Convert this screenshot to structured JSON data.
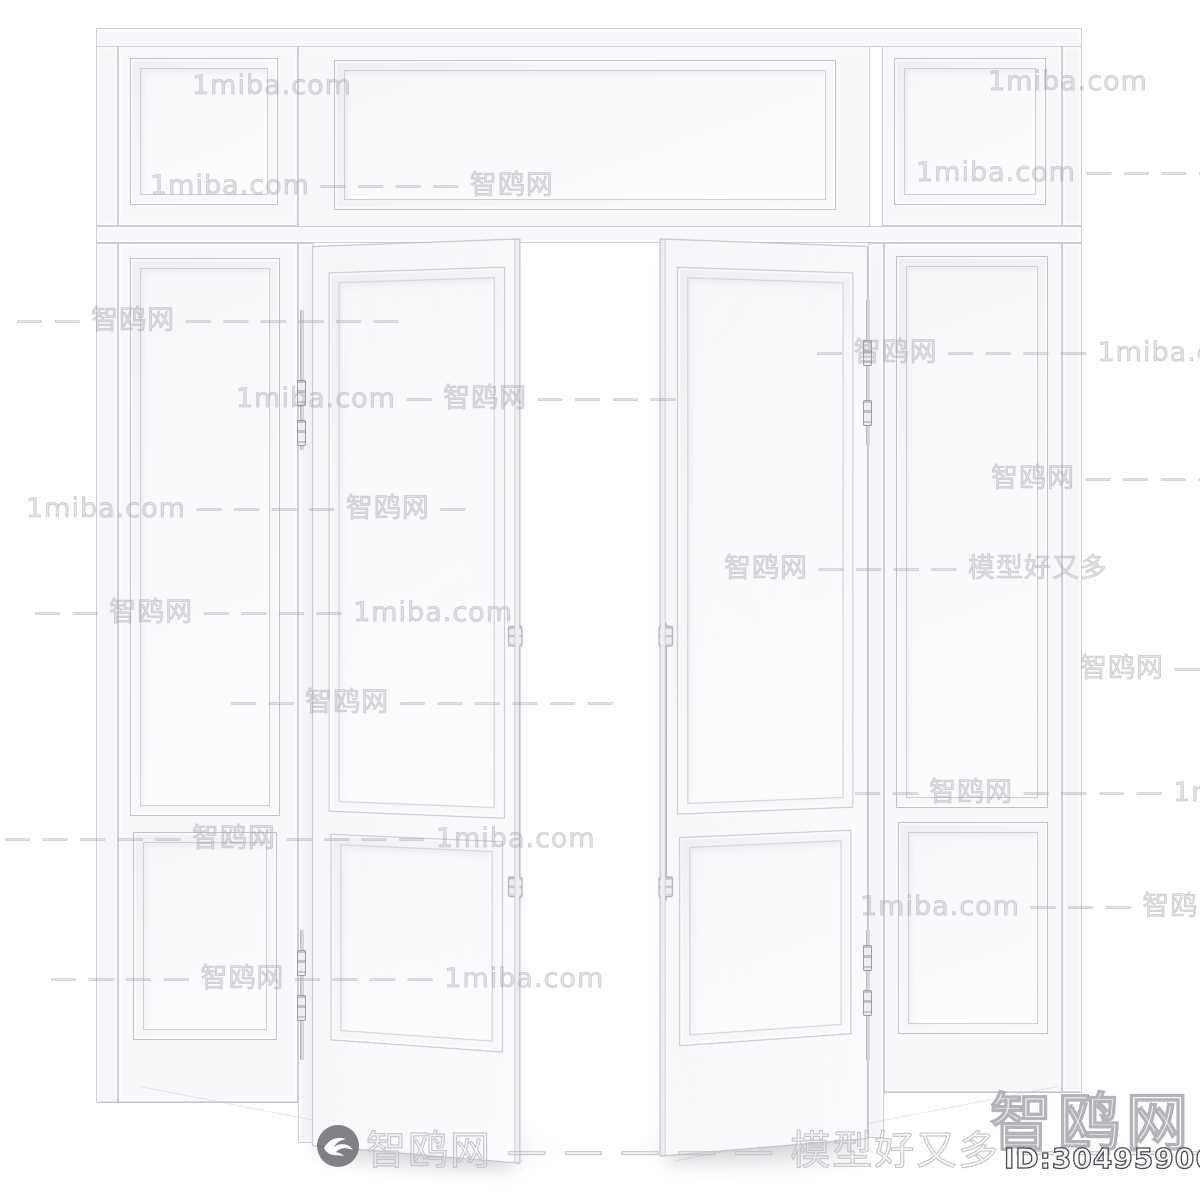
{
  "image": {
    "subject": "White classical double interior door, both leaves open, with side panels and transom above",
    "style": "clay 3D product render on white background"
  },
  "watermarks": {
    "brand": "智鸥网",
    "domain": "1miba.com",
    "slogan": "模型好又多",
    "corner_brand": "智鸥网",
    "model_id": "ID:304959062",
    "banner": "智鸥网 — — — — — 模型好又多 — — — —",
    "tiles": [
      {
        "text": "1miba.com"
      },
      {
        "text": "1miba.com"
      },
      {
        "text": "1miba.com — — — — 智鸥网"
      },
      {
        "text": "1miba.com — — — — 智鸥网 — —"
      },
      {
        "text": "— — 智鸥网 — — — — — —"
      },
      {
        "text": "— 智鸥网 — — — — 1miba.com"
      },
      {
        "text": "1miba.com — 智鸥网 — — — —"
      },
      {
        "text": "1miba.com — — — — 智鸥网 —"
      },
      {
        "text": "智鸥网 — — — — —"
      },
      {
        "text": "智鸥网 — — — — 模型好又多"
      },
      {
        "text": "— — 智鸥网 — — — — 1miba.com"
      },
      {
        "text": "— — 智鸥网 — — — — — —"
      },
      {
        "text": "智鸥网 —"
      },
      {
        "text": "— — — — — 智鸥网 — — — — 1miba.com"
      },
      {
        "text": "— — 智鸥网 — — — — 1miba.com"
      },
      {
        "text": "— — — — 智鸥网 — — — — 1miba.com"
      },
      {
        "text": "1miba.com — — — 智鸥网 — — — —"
      }
    ]
  }
}
